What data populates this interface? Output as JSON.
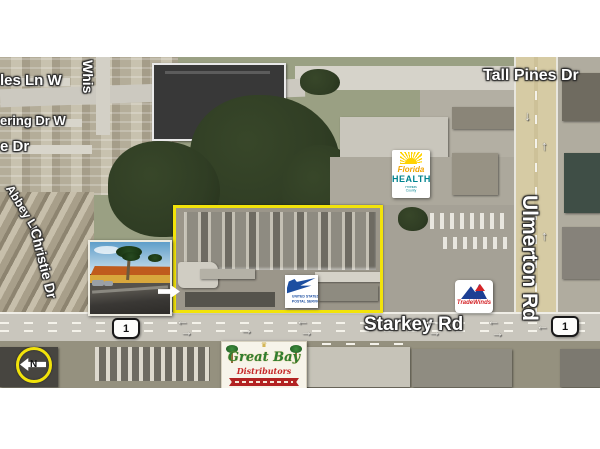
{
  "map": {
    "streets": {
      "tall_pines_dr": "Tall Pines Dr",
      "les_ln_w": "les Ln W",
      "whispering_partial": "Whis",
      "ering_dr_w": "ering Dr W",
      "e_dr": "e Dr",
      "abbey_ln": "Abbey Ln",
      "christie_dr": "Christie Dr",
      "starkey_rd": "Starkey Rd",
      "ulmerton_rd": "Ulmerton Rd"
    },
    "route_shields": {
      "starkey_west": "1",
      "starkey_east": "1"
    },
    "north_indicator": "N",
    "logos": {
      "florida_health": {
        "line1": "Florida",
        "line2": "HEALTH",
        "subtitle": "Pinellas County"
      },
      "usps": {
        "line1": "UNITED STATES",
        "line2": "POSTAL SERVICE"
      },
      "tradewinds": {
        "name": "TradeWinds"
      },
      "great_bay": {
        "line1": "Great Bay",
        "line2": "Distributors"
      }
    },
    "colors": {
      "highlight_yellow": "#f2e30a",
      "label_text": "#ffffff",
      "road_tan": "#d6cba4",
      "road_gray": "#c9c6bd"
    }
  }
}
